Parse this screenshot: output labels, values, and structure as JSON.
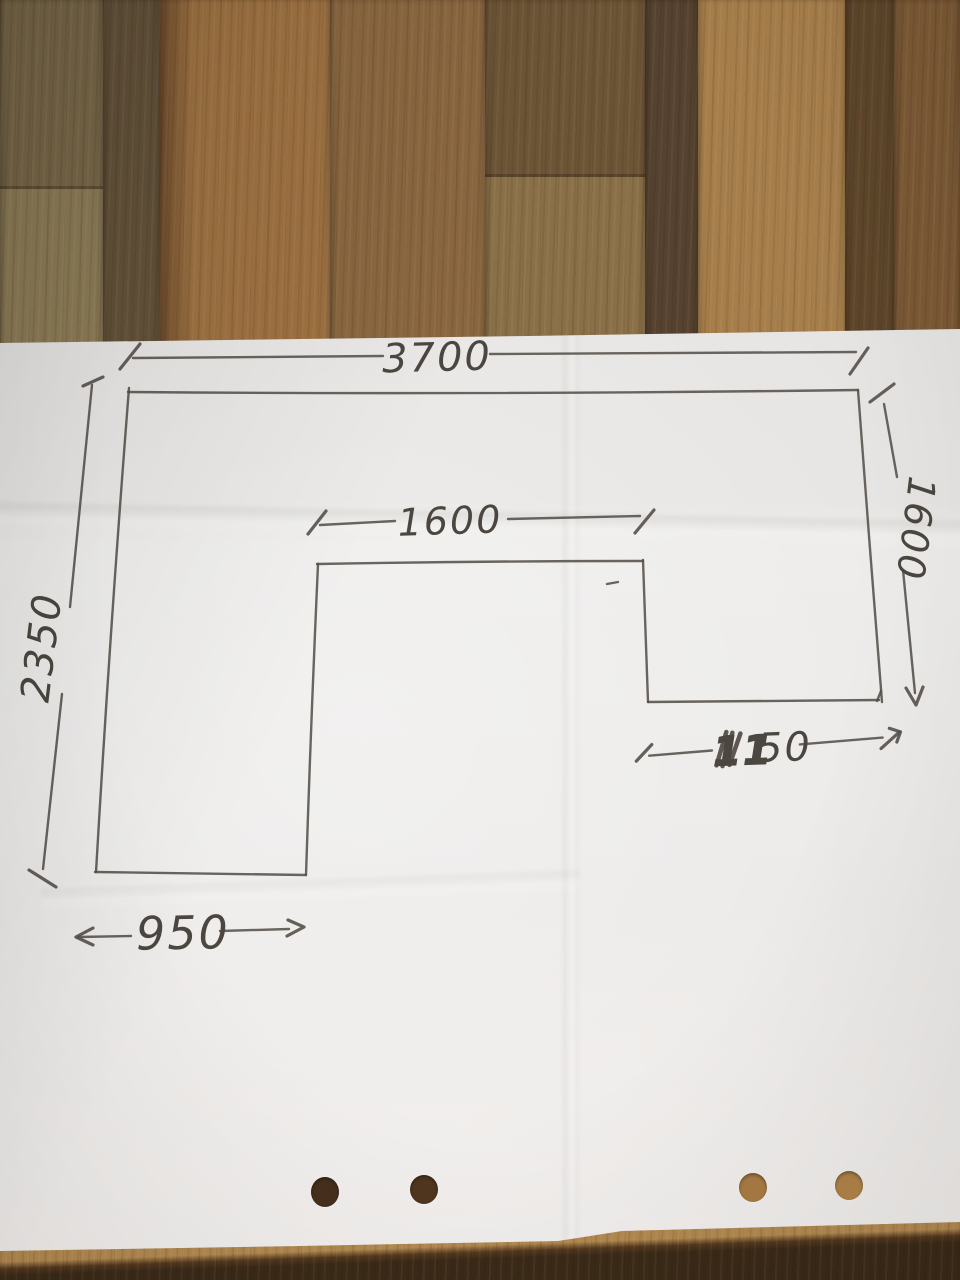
{
  "sketch": {
    "labels": {
      "top_width": "3700",
      "left_height": "2350",
      "inner_width": "1600",
      "right_height": "1600",
      "right_leg_width": {
        "value": "1150",
        "bold_part": "11",
        "rest_part": "50"
      },
      "bottom_left_width": "950"
    }
  },
  "colors": {
    "paper": "#eae8e6",
    "pencil_stroke": "#56504a",
    "pencil_text": "#4b4640",
    "wood_planks": [
      "#796849",
      "#63523a",
      "#9e7242",
      "#8a6740",
      "#6c5436",
      "#554230",
      "#a67e4b",
      "#5d462a",
      "#7b5935"
    ],
    "wood_plank1_lower": "#8d7c57",
    "wood_plank5_lower": "#8a7048",
    "table_shadow_band": "#64472a",
    "table_light_band": "#b28950",
    "table_dark_edge": "#3b2a18",
    "punch_holes": [
      "#46301c",
      "#50361e",
      "#a87b44",
      "#b08348"
    ]
  }
}
